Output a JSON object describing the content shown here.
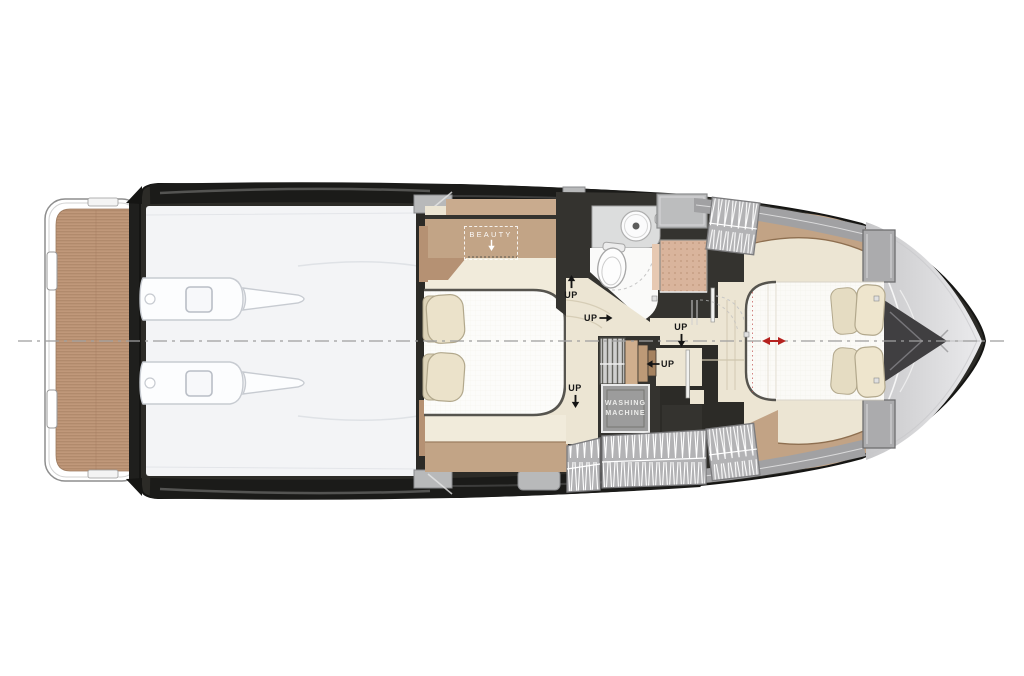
{
  "page": {
    "description": "Yacht lower deck floor plan, top view, bow pointing right",
    "background": "#ffffff"
  },
  "labels": {
    "beauty": "BEAUTY",
    "washing_machine": "WASHING\nMACHINE"
  },
  "stairs": [
    {
      "id": "stairs-mid-port",
      "label": "UP",
      "arrow": "up"
    },
    {
      "id": "stairs-landing",
      "label": "UP",
      "arrow": "right"
    },
    {
      "id": "stairs-corridor",
      "label": "UP",
      "arrow": "down"
    },
    {
      "id": "stairs-lower",
      "label": "UP",
      "arrow": "left"
    },
    {
      "id": "stairs-mid-starboard",
      "label": "UP",
      "arrow": "down"
    }
  ],
  "depicted_fixtures": [
    "swim-platform-teak-deck",
    "port-engine",
    "starboard-engine",
    "mid-cabin-double-bed",
    "beauty-cabinet",
    "bathroom-sink",
    "toilet",
    "shower",
    "staircase-steps",
    "washing-machine",
    "corridor",
    "forward-cabin-double-bed",
    "bow-deck",
    "centerline",
    "red-width-arrow"
  ],
  "colors": {
    "teak": "#bf9778",
    "wood_trim": "#c2a486",
    "floor_cream": "#ece5d3",
    "wall_dark": "#34332f",
    "hull_band": "#1d1d1b",
    "panel_gray": "#b3b3b5",
    "bow_deck": "#d9d9db",
    "bed_white": "#fbfaf7",
    "shower_tile": "#d9b49c",
    "accent_red": "#b5221f"
  }
}
